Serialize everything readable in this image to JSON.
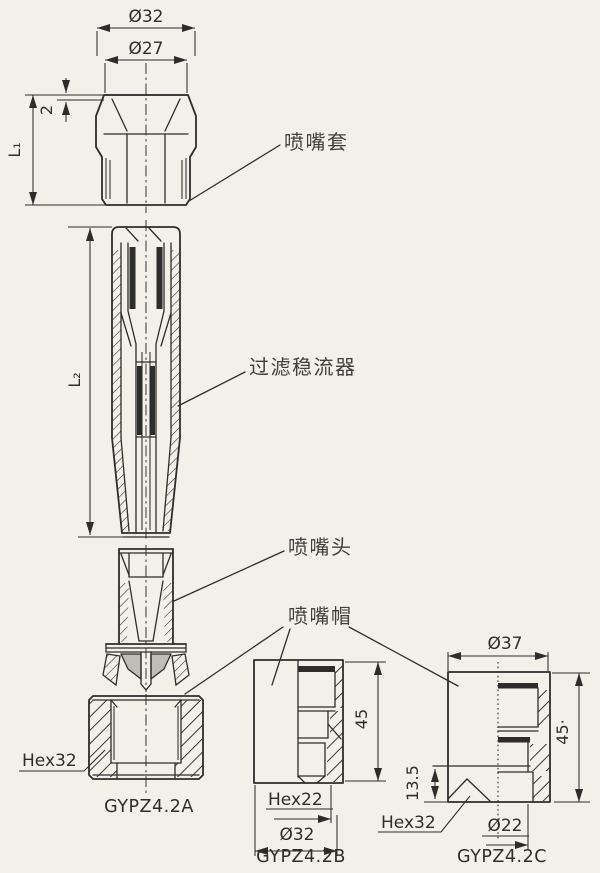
{
  "theme": {
    "bg": "#f2f0e9",
    "ink": "#2d2d2d",
    "label_ink": "#3f3f3f",
    "gray_fill": "#bfbdb8"
  },
  "parts": {
    "sleeve": {
      "label": "喷嘴套",
      "dim_outer": "Ø32",
      "dim_inner": "Ø27",
      "dim_step": "2",
      "dim_length": "L₁"
    },
    "filter": {
      "label": "过滤稳流器",
      "dim_length": "L₂"
    },
    "head": {
      "label": "喷嘴头"
    },
    "cap": {
      "label": "喷嘴帽"
    }
  },
  "views": {
    "a": {
      "model": "GYPZ4.2A",
      "hex": "Hex32"
    },
    "b": {
      "model": "GYPZ4.2B",
      "hex": "Hex22",
      "dim_outer": "Ø32",
      "dim_height": "45"
    },
    "c": {
      "model": "GYPZ4.2C",
      "hex": "Hex32",
      "dim_outer": "Ø37",
      "dim_inner": "Ø22",
      "dim_height": "45·",
      "dim_hex_height": "13.5"
    }
  }
}
